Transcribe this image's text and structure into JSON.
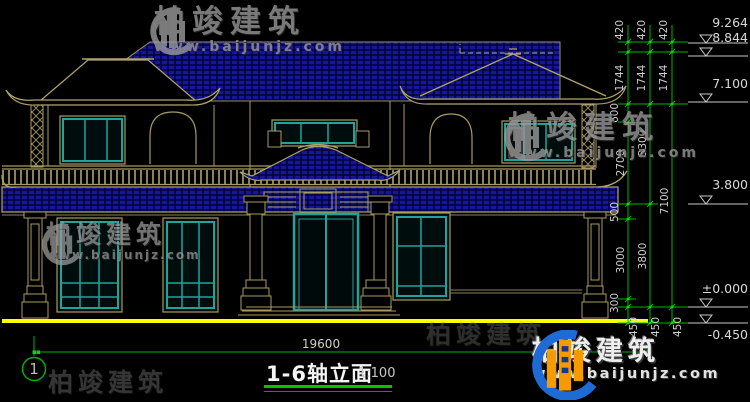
{
  "drawing": {
    "title": "1-6轴立面",
    "scale": "1:100",
    "axis_bubble": "1",
    "total_width_dim": "19600",
    "elevations": [
      "9.264",
      "8.844",
      "7.100",
      "3.800",
      "±0.000",
      "-0.450"
    ],
    "vertical_dims": [
      "420",
      "420",
      "420",
      "1744",
      "1744",
      "1744",
      "600",
      "2700",
      "500",
      "3000",
      "300",
      "3300",
      "3800",
      "7100",
      "450",
      "450",
      "450"
    ]
  },
  "watermark": {
    "brand": "柏竣建筑",
    "website": "www.baijunjz.com"
  },
  "colors": {
    "roof_blue": "#16169a",
    "line_tan": "#b0a46c",
    "window_teal": "#1fa39b",
    "dim_green": "#00b400",
    "ground_yellow": "#ffff00"
  }
}
